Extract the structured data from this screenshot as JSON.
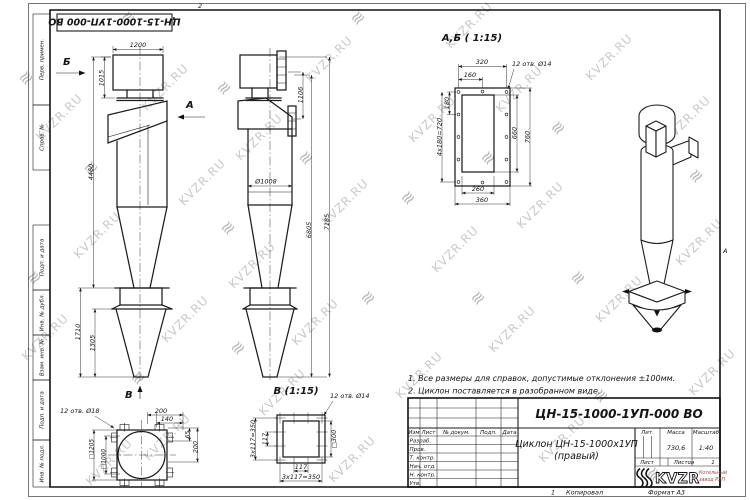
{
  "colors": {
    "line": "#1c1c1c",
    "watermark": "#c9c9c9",
    "logo_red": "#a34444"
  },
  "watermark": {
    "text": "KVZR.RU",
    "logo_glyph": "≋"
  },
  "sheet": {
    "top_stamp": "ЦН-15-1000-1УП-000 ВО",
    "fold_top": "2",
    "fold_bottom": "1",
    "fold_right": "А",
    "kopiroval": "Копировал",
    "format": "Формат А3",
    "side_labels": {
      "perv": "Перв. примен.",
      "sprav": "Справ. №",
      "podp1": "Подп. и дата",
      "inv_dubl": "Инв. № дубл.",
      "vzam": "Взам. инв. №",
      "podp2": "Подп. и дата",
      "inv_podl": "Инв. № подл."
    }
  },
  "notes": {
    "line1": "1. Все размеры для справок, допустимые отклонения ±100мм.",
    "line2": "2. Циклон поставляется в разобранном виде."
  },
  "front_view": {
    "dir_b": "Б",
    "dir_a": "А",
    "dir_v": "В",
    "d1200": "1200",
    "d1015": "1015",
    "d4460": "4460",
    "d1710": "1710",
    "d1305": "1305"
  },
  "side_view": {
    "d1106": "1106",
    "dia": "Ø1008",
    "d6805": "6805",
    "d7185": "7185"
  },
  "section_ab": {
    "title": "А,Б ( 1:15)",
    "holes": "12 отв. Ø14",
    "d320": "320",
    "d160": "160",
    "d180": "180",
    "d720": "4x180=720",
    "d660": "660",
    "d760": "760",
    "d260": "260",
    "d360": "360"
  },
  "view_v": {
    "title": "В (1:15)",
    "holes": "12 отв. Ø14",
    "left_total": "3x117=350",
    "d117_left": "117",
    "d117_bottom": "117",
    "bottom_total": "3x117=350",
    "sq300": "□300"
  },
  "bottom_view": {
    "holes": "12 отв. Ø18",
    "d200_top": "200",
    "d140": "140",
    "d65": "65",
    "d200_right": "200",
    "sq1205": "□1205",
    "sq1000": "□1000"
  },
  "title_block": {
    "doc_number": "ЦН-15-1000-1УП-000 ВО",
    "name1": "Циклон ЦН-15-1000х1УП",
    "name2": "(правый)",
    "col_izm": "Изм",
    "col_list": "Лист",
    "col_doc": "№ докум.",
    "col_podp": "Подп.",
    "col_data": "Дата",
    "rows": {
      "r1": "Разраб.",
      "r2": "Пров.",
      "r3": "Т. контр.",
      "r4": "Нач. отд.",
      "r5": "Н. контр.",
      "r6": "Утв."
    },
    "lit": "Лит.",
    "massa": "Масса",
    "masshtab": "Масштаб",
    "massa_val": "730,6",
    "masshtab_val": "1:40",
    "list": "Лист",
    "listov": "Листов",
    "listov_val": "1",
    "logo": "KVZR",
    "logo_sub1": "Котельный",
    "logo_sub2": "завод РЭП"
  }
}
